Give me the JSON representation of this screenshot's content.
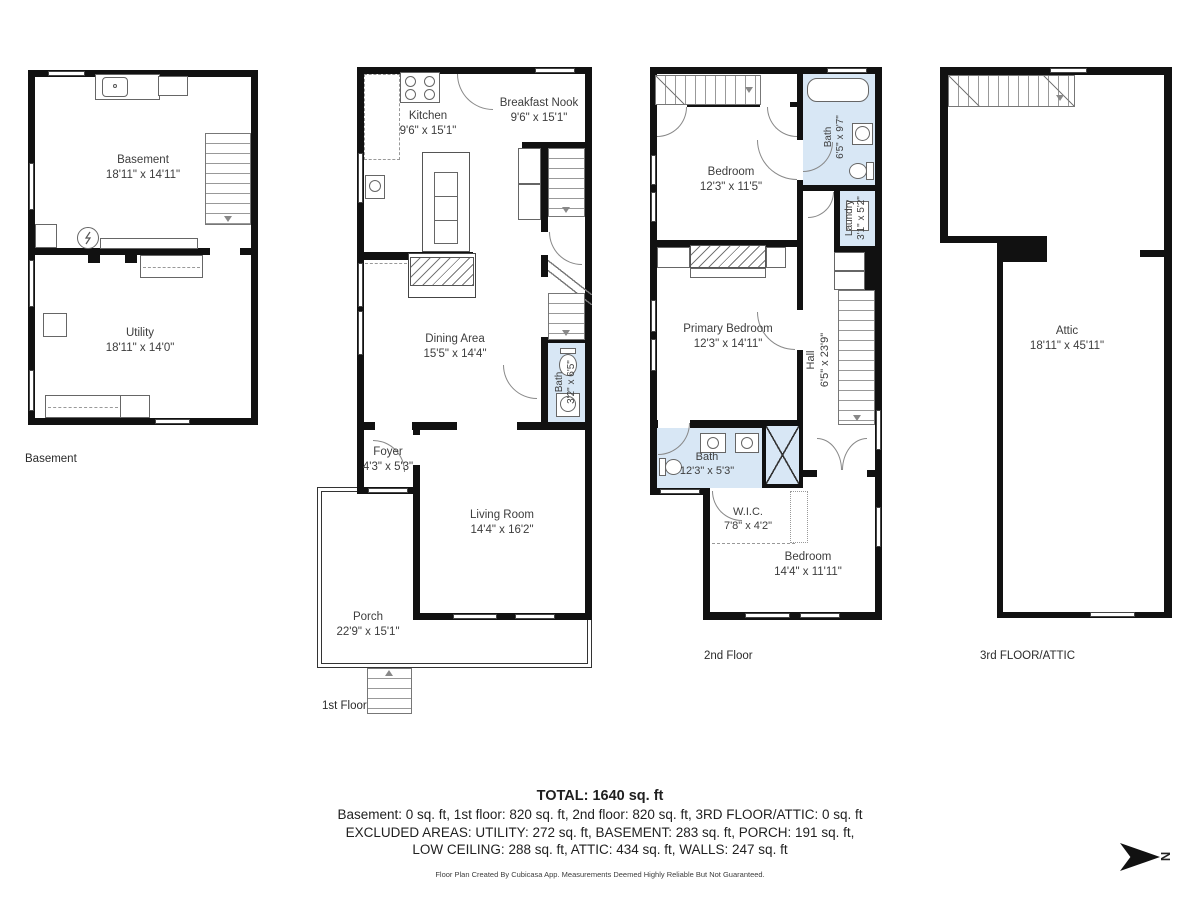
{
  "floors": [
    {
      "label": "Basement",
      "rooms": [
        {
          "name": "Basement",
          "dims": "18'11\" x 14'11\""
        },
        {
          "name": "Utility",
          "dims": "18'11\" x 14'0\""
        }
      ]
    },
    {
      "label": "1st Floor",
      "rooms": [
        {
          "name": "Kitchen",
          "dims": "9'6\" x 15'1\""
        },
        {
          "name": "Breakfast Nook",
          "dims": "9'6\" x 15'1\""
        },
        {
          "name": "Dining Area",
          "dims": "15'5\" x 14'4\""
        },
        {
          "name": "Bath",
          "dims": "3'2\" x 6'5\""
        },
        {
          "name": "Foyer",
          "dims": "4'3\" x 5'3\""
        },
        {
          "name": "Living Room",
          "dims": "14'4\" x 16'2\""
        },
        {
          "name": "Porch",
          "dims": "22'9\" x 15'1\""
        }
      ]
    },
    {
      "label": "2nd Floor",
      "rooms": [
        {
          "name": "Bedroom",
          "dims": "12'3\" x 11'5\""
        },
        {
          "name": "Bath",
          "dims": "6'5\" x 9'7\""
        },
        {
          "name": "Laundry",
          "dims": "3'1\" x 5'2\""
        },
        {
          "name": "Primary Bedroom",
          "dims": "12'3\" x 14'11\""
        },
        {
          "name": "Hall",
          "dims": "6'5\" x 23'9\""
        },
        {
          "name": "Bath",
          "dims": "12'3\" x 5'3\""
        },
        {
          "name": "W.I.C.",
          "dims": "7'8\" x 4'2\""
        },
        {
          "name": "Bedroom",
          "dims": "14'4\" x 11'11\""
        }
      ]
    },
    {
      "label": "3rd FLOOR/ATTIC",
      "rooms": [
        {
          "name": "Attic",
          "dims": "18'11\" x 45'11\""
        }
      ]
    }
  ],
  "summary": {
    "total": "TOTAL: 1640 sq. ft",
    "by_floor": "Basement: 0 sq. ft, 1st floor: 820 sq. ft, 2nd floor: 820 sq. ft, 3RD FLOOR/ATTIC: 0 sq. ft",
    "excluded_1": "EXCLUDED AREAS: UTILITY: 272 sq. ft, BASEMENT: 283 sq. ft, PORCH: 191 sq. ft,",
    "excluded_2": "LOW CEILING: 288 sq. ft, ATTIC: 434 sq. ft, WALLS: 247 sq. ft"
  },
  "disclaimer": "Floor Plan Created By Cubicasa App. Measurements Deemed Highly Reliable But Not Guaranteed.",
  "compass": {
    "label": "N"
  },
  "colors": {
    "wall": "#111111",
    "bath_fill": "#d8e7f5",
    "stair_line": "#999999",
    "text": "#3d3d3d"
  }
}
